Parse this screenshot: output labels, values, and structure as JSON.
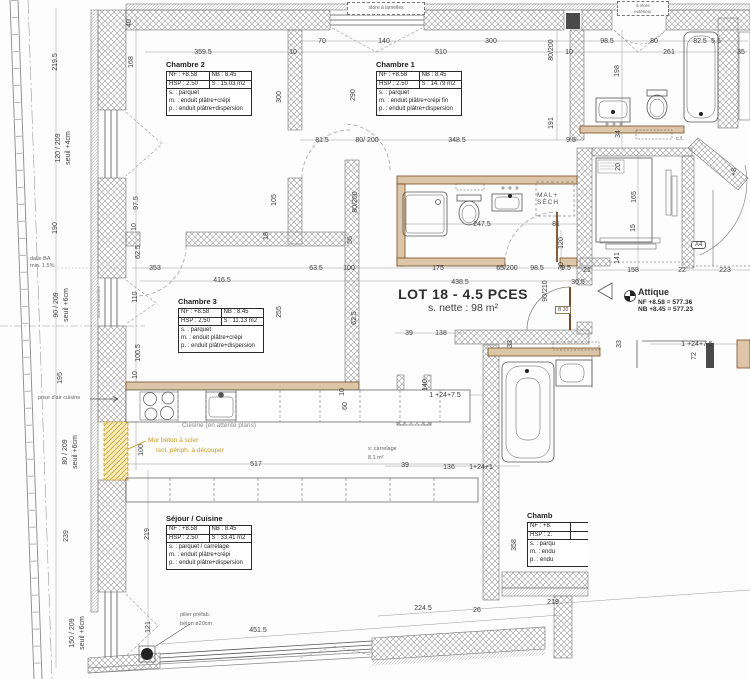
{
  "drawing": {
    "lot": {
      "title": "LOT 18 - 4.5 PCES",
      "net_area": "s. nette : 98 m²"
    },
    "attique": {
      "name": "Attique",
      "nf": "NF +8.58 = 577.36",
      "nb": "NB +8.45 = 577.23"
    },
    "rooms": {
      "chambre2": {
        "name": "Chambre 2",
        "nf": "NF : +8.58",
        "nb": "NB : 8.45",
        "hsp": "HSP : 2.50",
        "surface": "S : 15.03 m2",
        "floor": "s. : parquet",
        "walls": "m. : enduit plâtre+crépi",
        "ceiling": "p. : enduit plâtre+dispersion"
      },
      "chambre1": {
        "name": "Chambre 1",
        "nf": "NF : +8.58",
        "nb": "NB : 8.45",
        "hsp": "HSP : 2.50",
        "surface": "S : 14.79 m2",
        "floor": "s. : parquet",
        "walls": "m. : enduit plâtre+crépi fin",
        "ceiling": "p. : enduit plâtre+dispersion"
      },
      "chambre3": {
        "name": "Chambre 3",
        "nf": "NF : +8.58",
        "nb": "NB : 8.45",
        "hsp": "HSP : 2.50",
        "surface": "S : 11.13 m2",
        "floor": "s. : parquet",
        "walls": "m. : enduit plâtre+crépi",
        "ceiling": "p. : enduit plâtre+dispersion"
      },
      "sejour": {
        "name": "Séjour / Cuisine",
        "nf": "NF : +8.58",
        "nb": "NB : 8.45",
        "hsp": "HSP : 2.50",
        "surface": "S : 33.41 m2",
        "floor": "s. : parquet / carrelage",
        "walls": "m. : enduit plâtre+crépi",
        "ceiling": "p. : enduit plâtre+dispersion"
      },
      "chambre_cut": {
        "name": "Chamb",
        "nf": "NF : +8.",
        "hsp": "HSP : 2.",
        "floor": "s. : parqu",
        "walls": "m. : endu",
        "ceiling": "p. : endu"
      }
    },
    "labels": {
      "mal_sech_1": "MAL+",
      "mal_sech_2": "SÉCH",
      "cuisine_note": "Cuisine (en attente plans)",
      "mur_note_1": "Mur béton à scier",
      "mur_note_2": "Isol. périph. à découper",
      "carrelage_1": "s: carrelage",
      "carrelage_2": "8.1 m²",
      "pilier_1": "pilier préfab.",
      "pilier_2": "béton ø20cm",
      "dalle_1": "dalle BA",
      "dalle_2": "min. 1.5%",
      "prise_air": "prise d'air cuisine",
      "store_top_left": "store à lamelles",
      "store_top_right_1": "à store",
      "store_top_right_2": "extérieur",
      "store_left_wall": "store à lamelles",
      "b30": "B 30",
      "a4": "A4",
      "cf": "c.f."
    },
    "colors": {
      "wall_hatch": "#9b9b9b",
      "partition_brown": "#7a4a21",
      "note_orange": "#c7991c",
      "highlight_yellow": "#f6ecc0",
      "dim_text": "#3f3f3f"
    }
  },
  "dimensions": [
    {
      "x": 322,
      "y": 43,
      "t": "70"
    },
    {
      "x": 384,
      "y": 43,
      "t": "140"
    },
    {
      "x": 491,
      "y": 43,
      "t": "300"
    },
    {
      "x": 607,
      "y": 43,
      "t": "98.5"
    },
    {
      "x": 654,
      "y": 43,
      "t": "80"
    },
    {
      "x": 700,
      "y": 43,
      "t": "82.5"
    },
    {
      "x": 716,
      "y": 43,
      "t": "5.5"
    },
    {
      "x": 203,
      "y": 54,
      "t": "359.5"
    },
    {
      "x": 293,
      "y": 54,
      "t": "10"
    },
    {
      "x": 441,
      "y": 54,
      "t": "510"
    },
    {
      "x": 569,
      "y": 54,
      "t": "10"
    },
    {
      "x": 669,
      "y": 54,
      "t": "261"
    },
    {
      "x": 741,
      "y": 54,
      "t": "35"
    },
    {
      "x": 57,
      "y": 62,
      "t": "219.5",
      "r": 1
    },
    {
      "x": 60,
      "y": 148,
      "t": "120 / 209",
      "r": 1
    },
    {
      "x": 70,
      "y": 148,
      "t": "seuil +4cm",
      "r": 1
    },
    {
      "x": 57,
      "y": 228,
      "t": "190",
      "r": 1
    },
    {
      "x": 58,
      "y": 305,
      "t": "90 / 209",
      "r": 1
    },
    {
      "x": 68,
      "y": 305,
      "t": "seuil +6cm",
      "r": 1
    },
    {
      "x": 62,
      "y": 378,
      "t": "195",
      "r": 1
    },
    {
      "x": 67,
      "y": 452,
      "t": "80 / 209",
      "r": 1
    },
    {
      "x": 77,
      "y": 452,
      "t": "seuil +6cm",
      "r": 1
    },
    {
      "x": 68,
      "y": 536,
      "t": "239",
      "r": 1
    },
    {
      "x": 74,
      "y": 633,
      "t": "150 / 209",
      "r": 1
    },
    {
      "x": 84,
      "y": 633,
      "t": "seuil +6cm",
      "r": 1
    },
    {
      "x": 149,
      "y": 534,
      "t": "219",
      "r": 1
    },
    {
      "x": 150,
      "y": 627,
      "t": "121",
      "r": 1
    },
    {
      "x": 131,
      "y": 23,
      "t": "40",
      "r": 1
    },
    {
      "x": 133,
      "y": 62,
      "t": "168",
      "r": 1
    },
    {
      "x": 138,
      "y": 203,
      "t": "97.5",
      "r": 1
    },
    {
      "x": 140,
      "y": 252,
      "t": "62.5",
      "r": 1
    },
    {
      "x": 137,
      "y": 297,
      "t": "110",
      "r": 1
    },
    {
      "x": 140,
      "y": 353,
      "t": "100.5",
      "r": 1
    },
    {
      "x": 143,
      "y": 450,
      "t": "100",
      "r": 1
    },
    {
      "x": 136,
      "y": 227,
      "t": "10",
      "r": 1
    },
    {
      "x": 137,
      "y": 375,
      "t": "10",
      "r": 1
    },
    {
      "x": 281,
      "y": 97,
      "t": "300",
      "r": 1
    },
    {
      "x": 355,
      "y": 95,
      "t": "290",
      "r": 1
    },
    {
      "x": 553,
      "y": 50,
      "t": "80/200",
      "r": 1
    },
    {
      "x": 553,
      "y": 123,
      "t": "191",
      "r": 1
    },
    {
      "x": 276,
      "y": 200,
      "t": "105",
      "r": 1
    },
    {
      "x": 357,
      "y": 202,
      "t": "80/200",
      "r": 1
    },
    {
      "x": 352,
      "y": 240,
      "t": "56",
      "r": 1
    },
    {
      "x": 268,
      "y": 236,
      "t": "18",
      "r": 1
    },
    {
      "x": 322,
      "y": 142,
      "t": "81.5"
    },
    {
      "x": 367,
      "y": 142,
      "t": "80/ 200"
    },
    {
      "x": 457,
      "y": 142,
      "t": "348.5"
    },
    {
      "x": 571,
      "y": 142,
      "t": "9.5"
    },
    {
      "x": 482,
      "y": 226,
      "t": "247.5"
    },
    {
      "x": 556,
      "y": 226,
      "t": "81"
    },
    {
      "x": 563,
      "y": 243,
      "t": "120",
      "r": 1
    },
    {
      "x": 563,
      "y": 266,
      "t": "30",
      "r": 1
    },
    {
      "x": 155,
      "y": 270,
      "t": "353"
    },
    {
      "x": 316,
      "y": 270,
      "t": "63.5"
    },
    {
      "x": 349,
      "y": 270,
      "t": "100"
    },
    {
      "x": 438,
      "y": 270,
      "t": "175"
    },
    {
      "x": 507,
      "y": 270,
      "t": "65/200"
    },
    {
      "x": 537,
      "y": 270,
      "t": "98.5"
    },
    {
      "x": 566,
      "y": 270,
      "t": "9.5"
    },
    {
      "x": 222,
      "y": 282,
      "t": "416.5"
    },
    {
      "x": 460,
      "y": 284,
      "t": "438.5"
    },
    {
      "x": 578,
      "y": 284,
      "t": "30.5"
    },
    {
      "x": 547,
      "y": 291,
      "t": "90/210",
      "r": 1
    },
    {
      "x": 587,
      "y": 272,
      "t": "21"
    },
    {
      "x": 633,
      "y": 272,
      "t": "158"
    },
    {
      "x": 682,
      "y": 272,
      "t": "22"
    },
    {
      "x": 725,
      "y": 272,
      "t": "223"
    },
    {
      "x": 281,
      "y": 312,
      "t": "255",
      "r": 1
    },
    {
      "x": 356,
      "y": 318,
      "t": "62.5",
      "r": 1
    },
    {
      "x": 409,
      "y": 335,
      "t": "39"
    },
    {
      "x": 441,
      "y": 335,
      "t": "138"
    },
    {
      "x": 620,
      "y": 167,
      "t": "20",
      "r": 1
    },
    {
      "x": 636,
      "y": 197,
      "t": "165",
      "r": 1
    },
    {
      "x": 635,
      "y": 228,
      "t": "15",
      "r": 1
    },
    {
      "x": 619,
      "y": 258,
      "t": "141",
      "r": 1
    },
    {
      "x": 619,
      "y": 71,
      "t": "198",
      "r": 1
    },
    {
      "x": 620,
      "y": 134,
      "t": "34",
      "r": 1
    },
    {
      "x": 621,
      "y": 344,
      "t": "33",
      "r": 1
    },
    {
      "x": 512,
      "y": 344,
      "t": "33",
      "r": 1
    },
    {
      "x": 696,
      "y": 356,
      "t": "72",
      "r": 1
    },
    {
      "x": 516,
      "y": 545,
      "t": "358",
      "r": 1
    },
    {
      "x": 445,
      "y": 397,
      "t": "1 +24+7.5"
    },
    {
      "x": 697,
      "y": 346,
      "t": "1 +24+7.5"
    },
    {
      "x": 405,
      "y": 467,
      "t": "39"
    },
    {
      "x": 449,
      "y": 469,
      "t": "136"
    },
    {
      "x": 481,
      "y": 469,
      "t": "1+24+1"
    },
    {
      "x": 427,
      "y": 385,
      "t": "140",
      "r": 1
    },
    {
      "x": 344,
      "y": 392,
      "t": "10",
      "r": 1
    },
    {
      "x": 347,
      "y": 406,
      "t": "60",
      "r": 1
    },
    {
      "x": 256,
      "y": 466,
      "t": "517"
    },
    {
      "x": 423,
      "y": 610,
      "t": "224.5"
    },
    {
      "x": 477,
      "y": 612,
      "t": "26"
    },
    {
      "x": 553,
      "y": 604,
      "t": "219"
    },
    {
      "x": 258,
      "y": 632,
      "t": "451.5"
    },
    {
      "x": 736,
      "y": 172,
      "t": "+8",
      "r": 1
    }
  ]
}
